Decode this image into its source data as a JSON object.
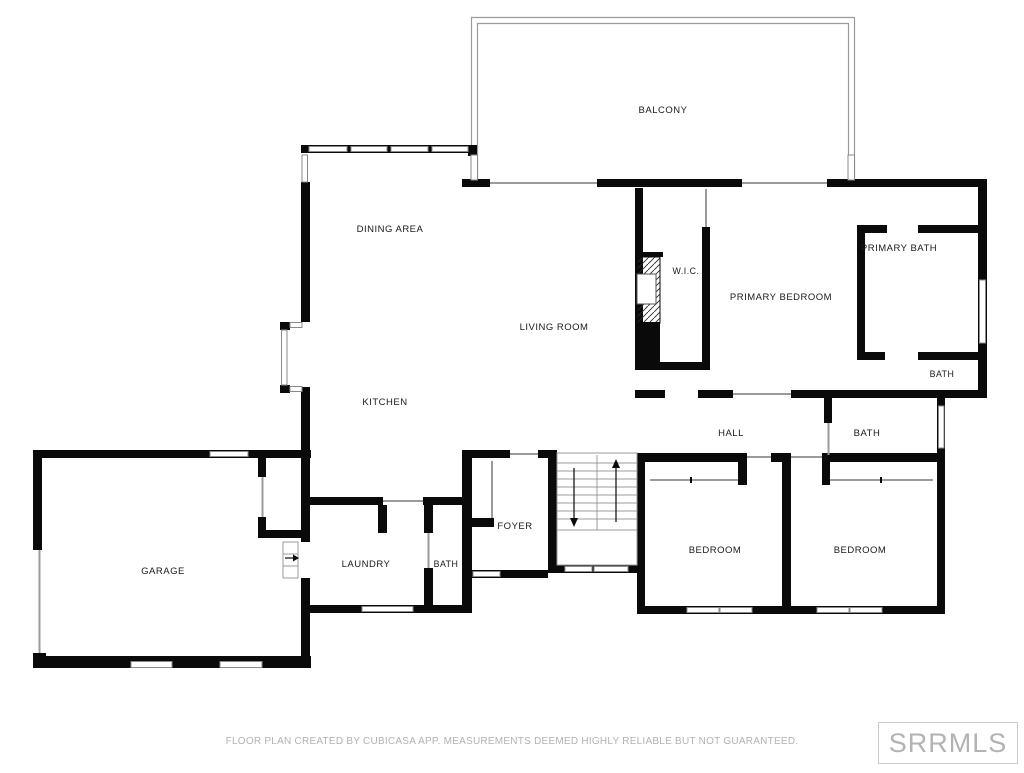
{
  "floor_plan": {
    "rooms": [
      {
        "label": "BALCONY"
      },
      {
        "label": "DINING AREA"
      },
      {
        "label": "PRIMARY BATH"
      },
      {
        "label": "W.I.C."
      },
      {
        "label": "PRIMARY BEDROOM"
      },
      {
        "label": "LIVING ROOM"
      },
      {
        "label": "BATH"
      },
      {
        "label": "KITCHEN"
      },
      {
        "label": "HALL"
      },
      {
        "label": "BATH"
      },
      {
        "label": "FOYER"
      },
      {
        "label": "BEDROOM"
      },
      {
        "label": "BEDROOM"
      },
      {
        "label": "LAUNDRY"
      },
      {
        "label": "BATH"
      },
      {
        "label": "GARAGE"
      }
    ],
    "colors": {
      "wall": "#0a0a0a",
      "opening_line": "#9b9b9b",
      "window_border": "#8a8a8a",
      "label_text": "#1a1a1a",
      "background": "#ffffff"
    },
    "stairs": {
      "arrows": [
        "up",
        "down"
      ]
    },
    "garage_steps": {
      "arrow": "right"
    }
  },
  "footer": {
    "text": "FLOOR PLAN CREATED BY CUBICASA APP. MEASUREMENTS DEEMED HIGHLY RELIABLE BUT NOT GUARANTEED.",
    "color": "#b2b2b2"
  },
  "watermark": {
    "text": "SRRMLS",
    "text_color": "#b3b3b3",
    "border_color": "#cccccc"
  }
}
